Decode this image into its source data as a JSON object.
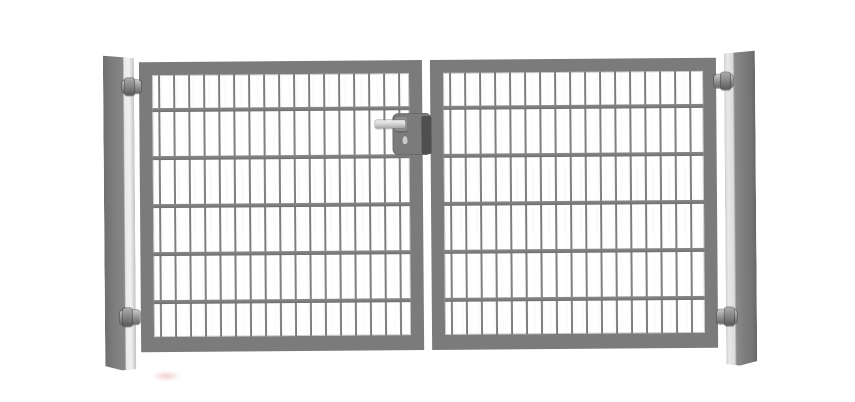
{
  "image": {
    "kind": "product-photo",
    "subject": "double-wing-metal-mesh-gate",
    "background_color": "#ffffff"
  },
  "colors": {
    "background": "#ffffff",
    "frame": "#7b7b7b",
    "mesh_vertical": "#747474",
    "mesh_horizontal": "#6f6f6f",
    "post_dark": "#7a7a7a",
    "post_light": "#ececec",
    "hinge": "#8f8f8f",
    "lock_shadow": "#4f4f4f",
    "handle_light": "#d6d6d6",
    "handle_dark": "#a5a5a5",
    "keyhole": "#c9c9c9",
    "smudge": "#e09a8e"
  },
  "gate": {
    "wing_count": 2,
    "post_count": 2,
    "hinge_count": 4,
    "lock": {
      "has_handle": true,
      "has_keyhole": true,
      "position": "center-meeting-stile"
    },
    "mesh": {
      "vertical_wire_count": 17,
      "vertical_inset_px": 6,
      "vertical_spacing_px": 15,
      "vertical_thickness_px": 2,
      "horizontal_wire_count": 5,
      "first_horizontal_offset_px": 33,
      "horizontal_spacing_px": 48,
      "horizontal_thickness_px": 4
    }
  }
}
